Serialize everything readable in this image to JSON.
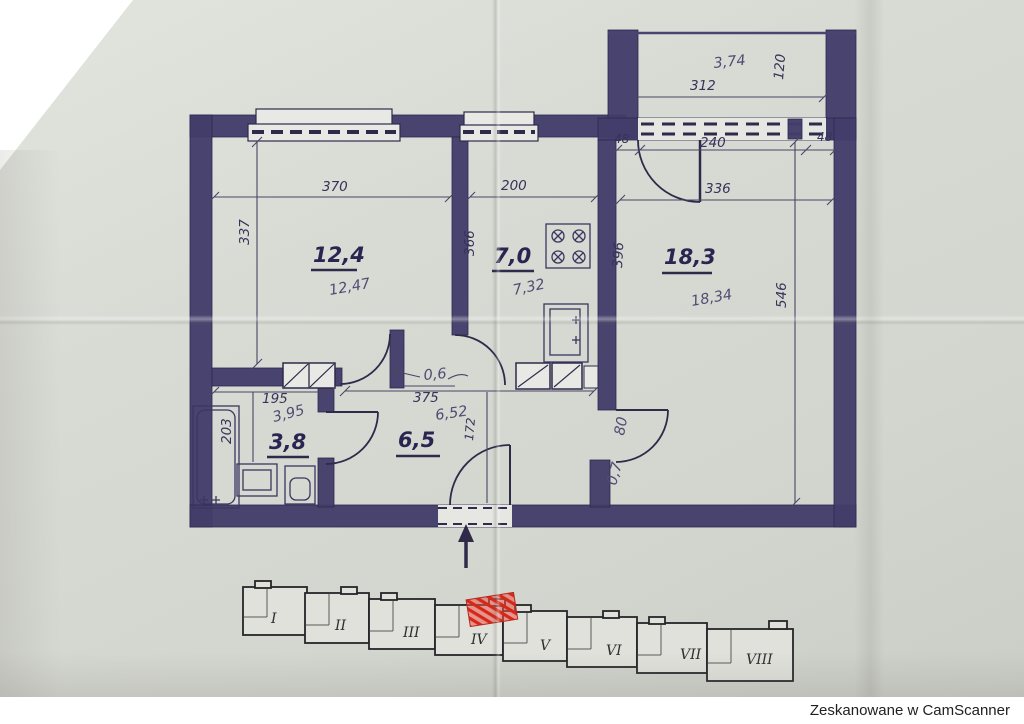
{
  "footer": {
    "text": "Zeskanowane w CamScanner"
  },
  "colors": {
    "wall": "#433d6a",
    "paper": "#d8dad4",
    "red_mark": "#d6281a"
  },
  "rooms": {
    "room1": {
      "area": "12,4",
      "pencil": "12,47",
      "width": "370",
      "depth": "337"
    },
    "kitchen": {
      "area": "7,0",
      "pencil": "7,32",
      "width": "200",
      "depth_left": "366",
      "depth_right": "396"
    },
    "room2": {
      "area": "18,3",
      "pencil": "18,34",
      "width": "336",
      "depth": "546"
    },
    "bathroom": {
      "area": "3,8",
      "pencil": "3,95",
      "width": "195",
      "depth": "203"
    },
    "hall": {
      "area": "6,5",
      "pencil": "6,52",
      "width": "375",
      "depth": "172"
    }
  },
  "balcony": {
    "pencil": "3,74",
    "width": "312",
    "depth": "120",
    "seg_left": "48",
    "seg_mid": "240",
    "seg_right": "48"
  },
  "notes": {
    "closet_width": "0,6",
    "door_width": "80",
    "door_note": "0,7"
  },
  "site_key": {
    "sections": [
      "I",
      "II",
      "III",
      "IV",
      "V",
      "VI",
      "VII",
      "VIII"
    ]
  }
}
